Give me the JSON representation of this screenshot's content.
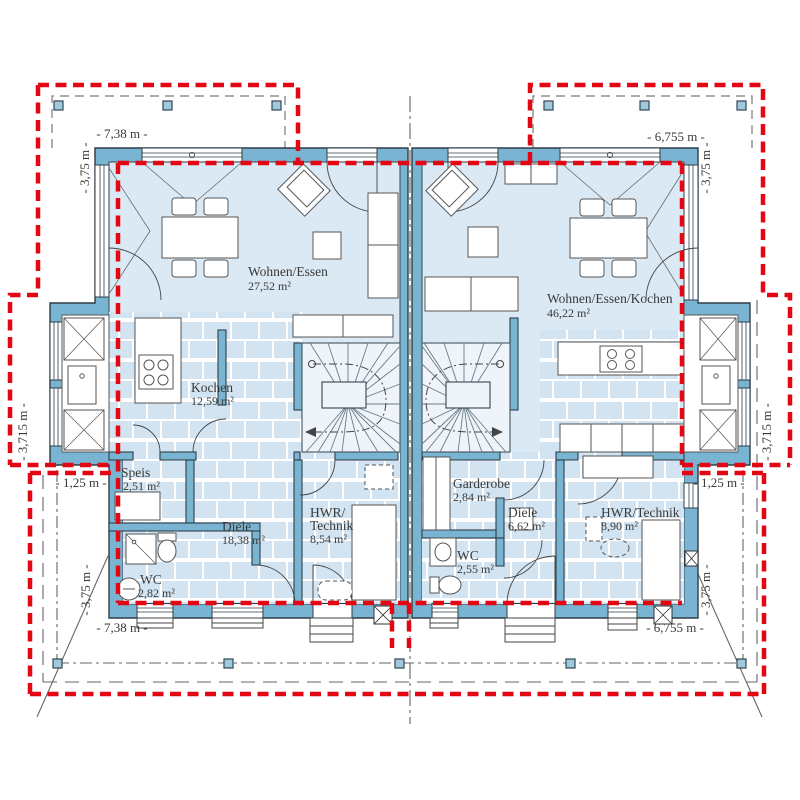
{
  "plan_type": "duplex-ground-floor-plan",
  "labels": {
    "wohnen_l": "Wohnen/Essen",
    "wohnen_l_area": "27,52 m²",
    "kochen": "Kochen",
    "kochen_area": "12,59 m²",
    "speis": "Speis",
    "speis_area": "2,51 m²",
    "diele_l": "Diele",
    "diele_l_area": "18,38 m²",
    "wc_l": "WC",
    "wc_l_area": "2,82 m²",
    "hwr_l1": "HWR/",
    "hwr_l2": "Technik",
    "hwr_l_area": "8,54 m²",
    "wohnen_r": "Wohnen/Essen/Kochen",
    "wohnen_r_area": "46,22 m²",
    "garderobe": "Garderobe",
    "garderobe_area": "2,84 m²",
    "diele_r": "Diele",
    "diele_r_area": "6,62 m²",
    "wc_r": "WC",
    "wc_r_area": "2,55 m²",
    "hwr_r": "HWR/Technik",
    "hwr_r_area": "8,90 m²"
  },
  "dims": {
    "top_left": "- 7,38 m -",
    "top_right": "- 6,755 m -",
    "bottom_left": "- 7,38 m -",
    "bottom_right": "- 6,755 m -",
    "left_upper": "- 3,75 m -",
    "left_mid": "- 3,715 m -",
    "left_bay": "- 1,25 m -",
    "left_lower": "- 3,75 m -",
    "right_upper": "- 3,75 m -",
    "right_mid": "- 3,715 m -",
    "right_bay": "- 1,25 m -",
    "right_lower": "- 3,75 m -"
  },
  "colors": {
    "wall": "#79b5d2",
    "room_fill": "#dbe9f5",
    "tile_fill": "#d2e3f1",
    "roof_outline_red": "#e30613",
    "line_dark": "#2e3d47",
    "post_fill": "#9fcade"
  }
}
